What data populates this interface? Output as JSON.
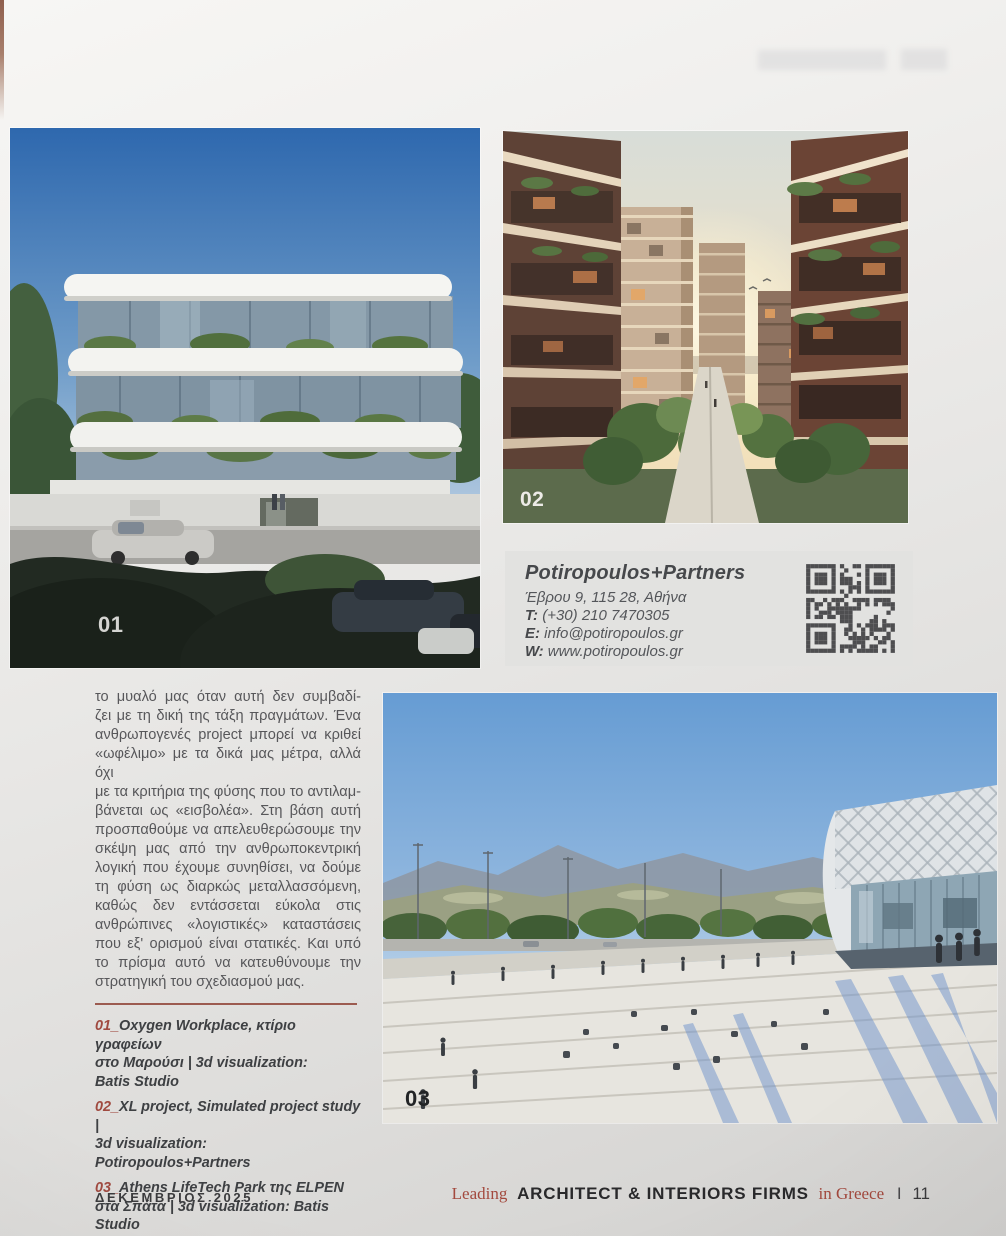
{
  "images": [
    {
      "label": "01"
    },
    {
      "label": "02"
    },
    {
      "label": "03"
    }
  ],
  "contact": {
    "name": "Potiropoulos+Partners",
    "address": "Έβρου 9, 115 28, Αθήνα",
    "phone_label": "T:",
    "phone": " (+30) 210 7470305",
    "email_label": "E:",
    "email": " info@potiropoulos.gr",
    "web_label": "W:",
    "web": " www.potiropoulos.gr"
  },
  "article": {
    "lines": "το μυαλό μας όταν αυτή δεν συμβαδί-\nζει με τη δική της τάξη πραγμάτων. Ένα\nανθρωπογενές project μπορεί να κριθεί\n«ωφέλιμο» με τα δικά μας μέτρα, αλλά όχι\nμε τα κριτήρια της φύσης που το αντιλαμ-\nβάνεται ως «εισβολέα». Στη βάση αυτή\nπροσπαθούμε να απελευθερώσουμε την\nσκέψη μας από την ανθρωποκεντρική\nλογική που έχουμε συνηθίσει, να δούμε\nτη φύση ως διαρκώς μεταλλασσόμενη,\nκαθώς δεν εντάσσεται εύκολα στις\nανθρώπινες «λογιστικές» καταστάσεις\nπου εξ' ορισμού είναι στατικές. Και υπό\nτο πρίσμα αυτό να κατευθύνουμε την",
    "last_line": "στρατηγική του σχεδιασμού μας."
  },
  "captions": [
    {
      "num": "01_",
      "text": "Oxygen Workplace, κτίριο γραφείων\nστο Μαρούσι | 3d visualization:\nBatis Studio"
    },
    {
      "num": "02_",
      "text": "XL project, Simulated project study |\n3d visualization: Potiropoulos+Partners"
    },
    {
      "num": "03_",
      "text": "Athens LifeTech Park της ELPEN\nστα Σπάτα | 3d visualization: Batis Studio"
    }
  ],
  "footer": {
    "date": "ΔΕΚΕΜΒΡΙΟΣ 2025",
    "leading": "Leading",
    "firms": "ARCHITECT & INTERIORS FIRMS",
    "in_greece": "in Greece",
    "separator": "I",
    "page_number": "11"
  },
  "colors": {
    "accent_red": "#a04a40",
    "body_text_gray": "#57575a",
    "page_background": "#e8e7e5",
    "contact_box_background": "#e2e2e0"
  }
}
